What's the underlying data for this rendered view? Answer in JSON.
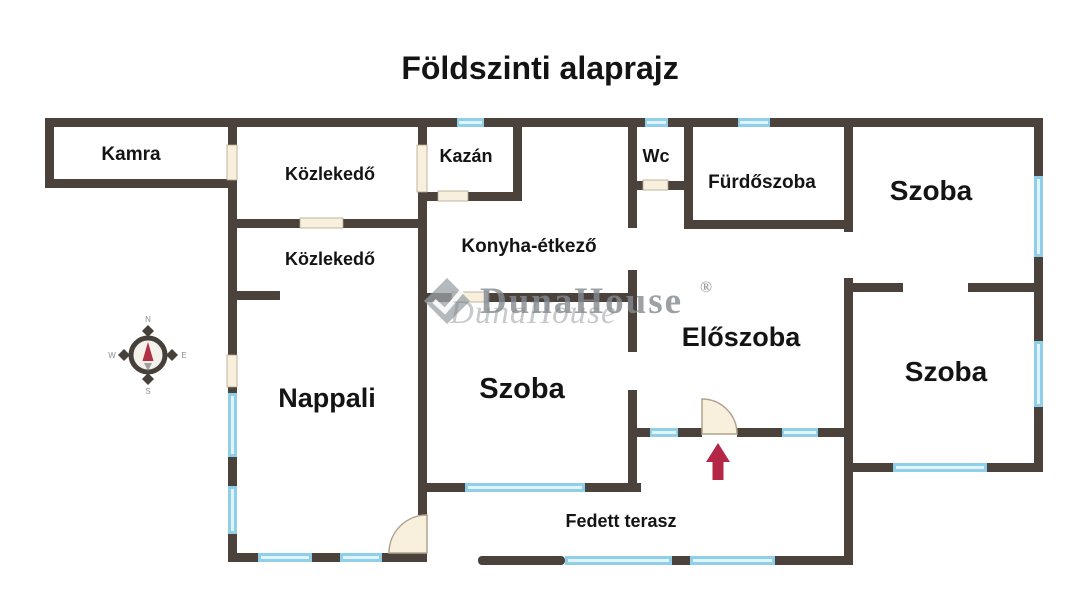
{
  "title": "Földszinti alaprajz",
  "rooms": [
    {
      "id": "kamra",
      "label": "Kamra"
    },
    {
      "id": "kozlekedo-felso",
      "label": "Közlekedő"
    },
    {
      "id": "kazan",
      "label": "Kazán"
    },
    {
      "id": "wc",
      "label": "Wc"
    },
    {
      "id": "furdoszoba",
      "label": "Fürdőszoba"
    },
    {
      "id": "szoba-jobb-felso",
      "label": "Szoba"
    },
    {
      "id": "kozlekedo-also",
      "label": "Közlekedő"
    },
    {
      "id": "konyha-etkezo",
      "label": "Konyha-étkező"
    },
    {
      "id": "eloszoba",
      "label": "Előszoba"
    },
    {
      "id": "nappali",
      "label": "Nappali"
    },
    {
      "id": "szoba-kozep",
      "label": "Szoba"
    },
    {
      "id": "szoba-jobb-also",
      "label": "Szoba"
    },
    {
      "id": "fedett-terasz",
      "label": "Fedett terasz"
    }
  ],
  "compass": {
    "north": "N",
    "east": "E",
    "south": "S",
    "west": "W"
  },
  "watermark": {
    "brand": "DunaHouse",
    "registered": "®"
  },
  "colors": {
    "wall": "#4b423c",
    "window": "#8fd0e8",
    "window_core": "#e2f4fb",
    "door": "#f8efdd",
    "door_stroke": "#b0a48e",
    "arrow": "#b52747",
    "watermark": "#848a90"
  }
}
